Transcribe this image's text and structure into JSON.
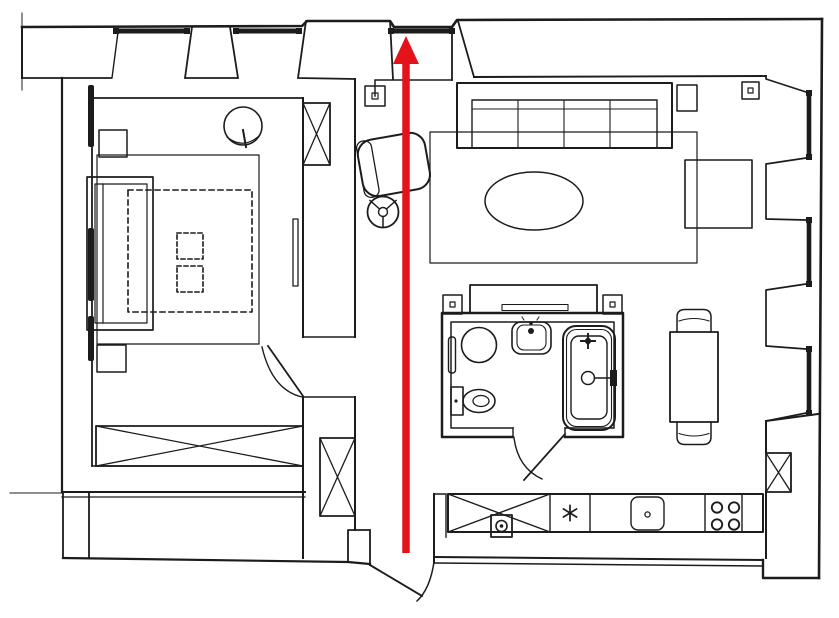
{
  "image": {
    "type": "apartment floor plan drawing",
    "width": 839,
    "height": 618,
    "background": "#ffffff",
    "line_color": "#1c1c1c"
  },
  "arrow": {
    "color": "#e41219",
    "direction": "up",
    "shaft_width": "7.5",
    "location": "vertical through corridor toward top window"
  },
  "windows": {
    "top_wall_count": 3,
    "right_wall_count": 3
  },
  "rooms": [
    {
      "id": "bedroom",
      "fixtures": [
        "bed",
        "rug",
        "duvet-dashed-outline",
        "dashed-cushion",
        "dashed-cushion",
        "nightstand",
        "nightstand",
        "potted-plant",
        "crossed-wardrobe",
        "radiator",
        "swing-door",
        "wall-hatch-marks"
      ]
    },
    {
      "id": "living-room",
      "fixtures": [
        "four-seat-sofa",
        "side-table",
        "rug",
        "oval-coffee-table",
        "square-table",
        "wall-socket"
      ]
    },
    {
      "id": "corridor",
      "fixtures": [
        "office-chair-seat",
        "office-chair-base",
        "wall-socket",
        "upper-duct-shaft",
        "lower-duct-shaft",
        "entry-door"
      ]
    },
    {
      "id": "bathroom",
      "fixtures": [
        "washing-machine",
        "towel-radiator",
        "toilet",
        "washbasin",
        "bathtub",
        "tub-mixer-star",
        "drain-shower-handle",
        "swing-door",
        "wardrobe-above",
        "wall-socket",
        "wall-socket"
      ]
    },
    {
      "id": "kitchen",
      "fixtures": [
        "crossed-cabinet",
        "meter-box",
        "burner-asterisk",
        "sink",
        "four-ring-hob",
        "corner-duct-shaft"
      ]
    },
    {
      "id": "dining-area",
      "fixtures": [
        "table",
        "chair",
        "chair"
      ]
    }
  ]
}
